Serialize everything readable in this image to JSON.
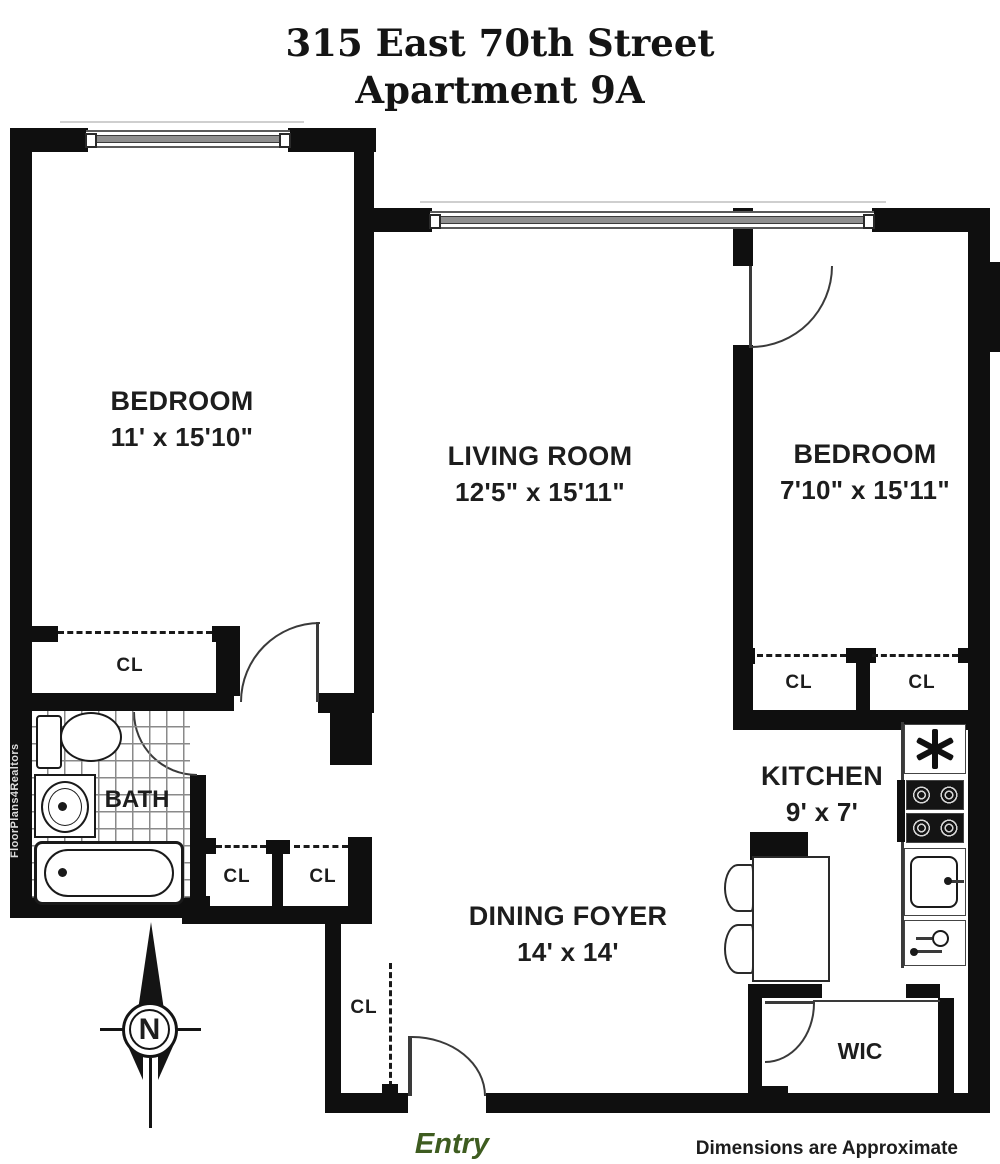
{
  "title": {
    "line1": "315 East 70th Street",
    "line2": "Apartment 9A"
  },
  "rooms": {
    "bedroom1": {
      "name": "BEDROOM",
      "dims": "11' x 15'10\""
    },
    "living": {
      "name": "LIVING ROOM",
      "dims": "12'5\" x 15'11\""
    },
    "bedroom2": {
      "name": "BEDROOM",
      "dims": "7'10\" x 15'11\""
    },
    "kitchen": {
      "name": "KITCHEN",
      "dims": "9' x 7'"
    },
    "dining": {
      "name": "DINING FOYER",
      "dims": "14' x 14'"
    },
    "bath": {
      "name": "BATH"
    },
    "wic": {
      "name": "WIC"
    }
  },
  "closets": [
    "CL",
    "CL",
    "CL",
    "CL",
    "CL",
    "CL"
  ],
  "compass": {
    "north": "N"
  },
  "footer": {
    "entry": "Entry",
    "disclaimer": "Dimensions are Approximate"
  },
  "watermark": "FloorPlans4Realtors",
  "colors": {
    "wall": "#0f0f0f",
    "entry_green": "#3e5c20",
    "text": "#1d1d1d"
  }
}
